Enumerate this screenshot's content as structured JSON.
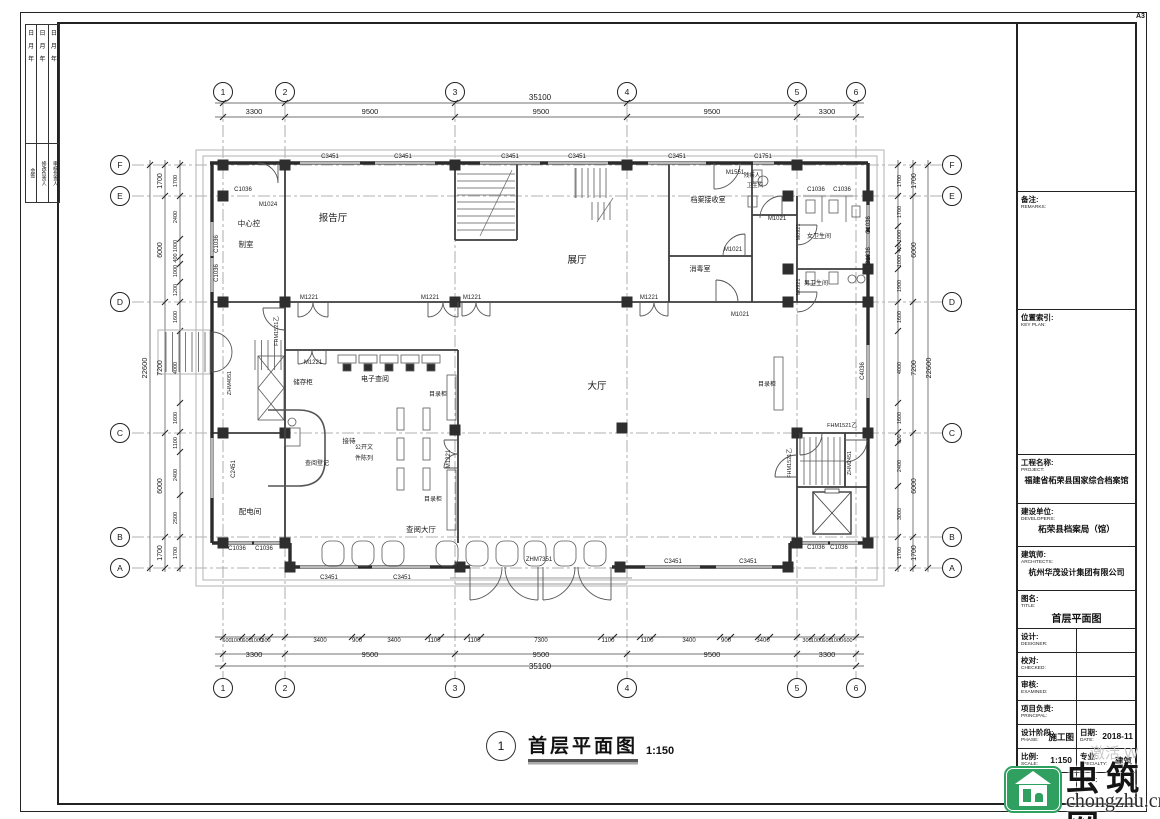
{
  "sheet": {
    "size_label": "A3"
  },
  "corner_strip": {
    "date_chars": [
      "日",
      "月",
      "年"
    ],
    "column_labels": [
      "会签",
      "修改负责人",
      "审核负责人"
    ]
  },
  "title_block": {
    "remarks": {
      "zh": "备注:",
      "en": "REMARKS:"
    },
    "key_plan": {
      "zh": "位置索引:",
      "en": "KEY PLAN:"
    },
    "project": {
      "zh": "工程名称:",
      "en": "PROJECT:",
      "value": "福建省柘荣县国家综合档案馆"
    },
    "developers": {
      "zh": "建设单位:",
      "en": "DEVELOPERS:",
      "value": "柘荣县档案局（馆）"
    },
    "architects": {
      "zh": "建筑师:",
      "en": "ARCHITECTS:",
      "value": "杭州华茂设计集团有限公司"
    },
    "title": {
      "zh": "图名:",
      "en": "TITLE:",
      "value": "首层平面图"
    },
    "designer": {
      "zh": "设计:",
      "en": "DESIGNER:"
    },
    "checked": {
      "zh": "校对:",
      "en": "CHECKED:"
    },
    "examined": {
      "zh": "审核:",
      "en": "EXAMINED:"
    },
    "principal": {
      "zh": "项目负责:",
      "en": "PRINCIPAL:"
    },
    "phase": {
      "zh": "设计阶段:",
      "en": "PHASE:",
      "value": "施工图"
    },
    "date": {
      "zh": "日期:",
      "en": "DATE:",
      "value": "2018-11"
    },
    "scale": {
      "zh": "比例:",
      "en": "SCALE:",
      "value": "1:150"
    },
    "specialty": {
      "zh": "专业:",
      "en": "SPECIALTY:",
      "value": "建筑"
    },
    "dwg_no": {
      "zh": "图号:",
      "en": "DWG. NO:"
    },
    "rev": "REV:"
  },
  "drawing_title": {
    "number": "1",
    "name": "首层平面图",
    "scale": "1:150"
  },
  "watermark": {
    "site_name": "虫筑网",
    "domain": "chongzhu.cn",
    "brand_color": "#2fa05f",
    "activation_text": "激活 W"
  },
  "dimensions": {
    "top": {
      "total": "35100",
      "segments": [
        "3300",
        "9500",
        "9500",
        "9500",
        "3300"
      ]
    },
    "bottom": {
      "total": "35100",
      "segments": [
        "3300",
        "9500",
        "9500",
        "9500",
        "3300"
      ],
      "detail": [
        "600",
        "1000",
        "600",
        "1000",
        "300",
        "3400",
        "900",
        "3400",
        "1100",
        "1100",
        "7300",
        "1100",
        "1100",
        "3400",
        "900",
        "3400",
        "300",
        "1000",
        "600",
        "1000",
        "600"
      ]
    },
    "left": {
      "total": "22600",
      "segments": [
        "1700",
        "6000",
        "7200",
        "6000",
        "1700"
      ],
      "detail": [
        "1700",
        "2400",
        "1000",
        "400",
        "1000",
        "1200",
        "1600",
        "4000",
        "1600",
        "1100",
        "2400",
        "2500",
        "1700"
      ]
    },
    "right": {
      "total": "22600",
      "segments": [
        "1700",
        "6000",
        "7200",
        "6000",
        "1700"
      ],
      "detail": [
        "1700",
        "1700",
        "1000",
        "400",
        "1000",
        "1900",
        "1600",
        "4000",
        "1600",
        "600",
        "2400",
        "3000",
        "1700"
      ]
    }
  },
  "plan": {
    "bubbles": [
      {
        "t": "1",
        "x": 223,
        "y": 92
      },
      {
        "t": "2",
        "x": 285,
        "y": 92
      },
      {
        "t": "3",
        "x": 455,
        "y": 92
      },
      {
        "t": "4",
        "x": 627,
        "y": 92
      },
      {
        "t": "5",
        "x": 797,
        "y": 92
      },
      {
        "t": "6",
        "x": 856,
        "y": 92
      },
      {
        "t": "1",
        "x": 223,
        "y": 688
      },
      {
        "t": "2",
        "x": 285,
        "y": 688
      },
      {
        "t": "3",
        "x": 455,
        "y": 688
      },
      {
        "t": "4",
        "x": 627,
        "y": 688
      },
      {
        "t": "5",
        "x": 797,
        "y": 688
      },
      {
        "t": "6",
        "x": 856,
        "y": 688
      },
      {
        "t": "F",
        "x": 120,
        "y": 165
      },
      {
        "t": "E",
        "x": 120,
        "y": 196
      },
      {
        "t": "D",
        "x": 120,
        "y": 302
      },
      {
        "t": "C",
        "x": 120,
        "y": 433
      },
      {
        "t": "B",
        "x": 120,
        "y": 537
      },
      {
        "t": "A",
        "x": 120,
        "y": 568
      },
      {
        "t": "F",
        "x": 952,
        "y": 165
      },
      {
        "t": "E",
        "x": 952,
        "y": 196
      },
      {
        "t": "D",
        "x": 952,
        "y": 302
      },
      {
        "t": "C",
        "x": 952,
        "y": 433
      },
      {
        "t": "B",
        "x": 952,
        "y": 537
      },
      {
        "t": "A",
        "x": 952,
        "y": 568
      }
    ],
    "labels": [
      {
        "t": "35100",
        "x": 540,
        "y": 100,
        "fs": 8
      },
      {
        "t": "3300",
        "x": 254,
        "y": 114,
        "fs": 7.5
      },
      {
        "t": "9500",
        "x": 370,
        "y": 114,
        "fs": 7.5
      },
      {
        "t": "9500",
        "x": 541,
        "y": 114,
        "fs": 7.5
      },
      {
        "t": "9500",
        "x": 712,
        "y": 114,
        "fs": 7.5
      },
      {
        "t": "3300",
        "x": 827,
        "y": 114,
        "fs": 7.5
      },
      {
        "t": "600",
        "x": 227,
        "y": 642,
        "fs": 5.5
      },
      {
        "t": "1000",
        "x": 237,
        "y": 642,
        "fs": 5.5
      },
      {
        "t": "600",
        "x": 247,
        "y": 642,
        "fs": 5.5
      },
      {
        "t": "1000",
        "x": 257,
        "y": 642,
        "fs": 5.5
      },
      {
        "t": "300",
        "x": 266,
        "y": 642,
        "fs": 5.5
      },
      {
        "t": "3400",
        "x": 320,
        "y": 642,
        "fs": 6
      },
      {
        "t": "900",
        "x": 357,
        "y": 642,
        "fs": 6
      },
      {
        "t": "3400",
        "x": 394,
        "y": 642,
        "fs": 6
      },
      {
        "t": "1100",
        "x": 434,
        "y": 642,
        "fs": 6
      },
      {
        "t": "1100",
        "x": 474,
        "y": 642,
        "fs": 6
      },
      {
        "t": "7300",
        "x": 541,
        "y": 642,
        "fs": 6
      },
      {
        "t": "1100",
        "x": 608,
        "y": 642,
        "fs": 6
      },
      {
        "t": "1100",
        "x": 647,
        "y": 642,
        "fs": 6
      },
      {
        "t": "3400",
        "x": 689,
        "y": 642,
        "fs": 6
      },
      {
        "t": "900",
        "x": 726,
        "y": 642,
        "fs": 6
      },
      {
        "t": "3400",
        "x": 763,
        "y": 642,
        "fs": 6
      },
      {
        "t": "300",
        "x": 807,
        "y": 642,
        "fs": 5.5
      },
      {
        "t": "1000",
        "x": 817,
        "y": 642,
        "fs": 5.5
      },
      {
        "t": "600",
        "x": 827,
        "y": 642,
        "fs": 5.5
      },
      {
        "t": "1000",
        "x": 837,
        "y": 642,
        "fs": 5.5
      },
      {
        "t": "600",
        "x": 848,
        "y": 642,
        "fs": 5.5
      },
      {
        "t": "3300",
        "x": 254,
        "y": 657,
        "fs": 7.5
      },
      {
        "t": "9500",
        "x": 370,
        "y": 657,
        "fs": 7.5
      },
      {
        "t": "9500",
        "x": 541,
        "y": 657,
        "fs": 7.5
      },
      {
        "t": "9500",
        "x": 712,
        "y": 657,
        "fs": 7.5
      },
      {
        "t": "3300",
        "x": 827,
        "y": 657,
        "fs": 7.5
      },
      {
        "t": "35100",
        "x": 540,
        "y": 669,
        "fs": 8
      },
      {
        "t": "22600",
        "x": 147,
        "y": 368,
        "fs": 7.5,
        "r": -90
      },
      {
        "t": "1700",
        "x": 162,
        "y": 181,
        "fs": 7,
        "r": -90
      },
      {
        "t": "6000",
        "x": 162,
        "y": 250,
        "fs": 7,
        "r": -90
      },
      {
        "t": "7200",
        "x": 162,
        "y": 368,
        "fs": 7,
        "r": -90
      },
      {
        "t": "6000",
        "x": 162,
        "y": 486,
        "fs": 7,
        "r": -90
      },
      {
        "t": "1700",
        "x": 162,
        "y": 553,
        "fs": 7,
        "r": -90
      },
      {
        "t": "1700",
        "x": 177,
        "y": 181,
        "fs": 5.5,
        "r": -90
      },
      {
        "t": "2400",
        "x": 177,
        "y": 217,
        "fs": 5.5,
        "r": -90
      },
      {
        "t": "1000",
        "x": 177,
        "y": 246,
        "fs": 5.5,
        "r": -90
      },
      {
        "t": "400",
        "x": 177,
        "y": 258,
        "fs": 5.5,
        "r": -90
      },
      {
        "t": "1000",
        "x": 177,
        "y": 271,
        "fs": 5.5,
        "r": -90
      },
      {
        "t": "1200",
        "x": 177,
        "y": 290,
        "fs": 5.5,
        "r": -90
      },
      {
        "t": "1600",
        "x": 177,
        "y": 317,
        "fs": 5.5,
        "r": -90
      },
      {
        "t": "4000",
        "x": 177,
        "y": 368,
        "fs": 5.5,
        "r": -90
      },
      {
        "t": "1600",
        "x": 177,
        "y": 418,
        "fs": 5.5,
        "r": -90
      },
      {
        "t": "1100",
        "x": 177,
        "y": 443,
        "fs": 5.5,
        "r": -90
      },
      {
        "t": "2400",
        "x": 177,
        "y": 475,
        "fs": 5.5,
        "r": -90
      },
      {
        "t": "2500",
        "x": 177,
        "y": 518,
        "fs": 5.5,
        "r": -90
      },
      {
        "t": "1700",
        "x": 177,
        "y": 553,
        "fs": 5.5,
        "r": -90
      },
      {
        "t": "22600",
        "x": 931,
        "y": 368,
        "fs": 7.5,
        "r": -90
      },
      {
        "t": "1700",
        "x": 916,
        "y": 181,
        "fs": 7,
        "r": -90
      },
      {
        "t": "6000",
        "x": 916,
        "y": 250,
        "fs": 7,
        "r": -90
      },
      {
        "t": "7200",
        "x": 916,
        "y": 368,
        "fs": 7,
        "r": -90
      },
      {
        "t": "6000",
        "x": 916,
        "y": 486,
        "fs": 7,
        "r": -90
      },
      {
        "t": "1700",
        "x": 916,
        "y": 553,
        "fs": 7,
        "r": -90
      },
      {
        "t": "1700",
        "x": 901,
        "y": 181,
        "fs": 5.5,
        "r": -90
      },
      {
        "t": "1700",
        "x": 901,
        "y": 212,
        "fs": 5.5,
        "r": -90
      },
      {
        "t": "1000",
        "x": 901,
        "y": 236,
        "fs": 5.5,
        "r": -90
      },
      {
        "t": "400",
        "x": 901,
        "y": 248,
        "fs": 5.5,
        "r": -90
      },
      {
        "t": "1000",
        "x": 901,
        "y": 261,
        "fs": 5.5,
        "r": -90
      },
      {
        "t": "1900",
        "x": 901,
        "y": 286,
        "fs": 5.5,
        "r": -90
      },
      {
        "t": "1600",
        "x": 901,
        "y": 317,
        "fs": 5.5,
        "r": -90
      },
      {
        "t": "4000",
        "x": 901,
        "y": 368,
        "fs": 5.5,
        "r": -90
      },
      {
        "t": "1600",
        "x": 901,
        "y": 418,
        "fs": 5.5,
        "r": -90
      },
      {
        "t": "600",
        "x": 901,
        "y": 439,
        "fs": 5.5,
        "r": -90
      },
      {
        "t": "2400",
        "x": 901,
        "y": 466,
        "fs": 5.5,
        "r": -90
      },
      {
        "t": "3000",
        "x": 901,
        "y": 514,
        "fs": 5.5,
        "r": -90
      },
      {
        "t": "1700",
        "x": 901,
        "y": 553,
        "fs": 5.5,
        "r": -90
      },
      {
        "t": "中心控",
        "x": 249,
        "y": 226,
        "fs": 7.5,
        "n": "room-label"
      },
      {
        "t": "制室",
        "x": 246,
        "y": 247,
        "fs": 7.5,
        "n": "room-label"
      },
      {
        "t": "报告厅",
        "x": 333,
        "y": 221,
        "fs": 9.5,
        "n": "room-label"
      },
      {
        "t": "展厅",
        "x": 577,
        "y": 263,
        "fs": 9.5,
        "n": "room-label"
      },
      {
        "t": "档案接收室",
        "x": 708,
        "y": 202,
        "fs": 7,
        "n": "room-label"
      },
      {
        "t": "消毒室",
        "x": 700,
        "y": 271,
        "fs": 7,
        "n": "room-label"
      },
      {
        "t": "残疾人",
        "x": 752,
        "y": 177,
        "fs": 5.5,
        "n": "room-label"
      },
      {
        "t": "卫生间",
        "x": 755,
        "y": 187,
        "fs": 5.5,
        "n": "room-label"
      },
      {
        "t": "女卫生间",
        "x": 819,
        "y": 238,
        "fs": 6,
        "n": "room-label"
      },
      {
        "t": "男卫生间",
        "x": 816,
        "y": 285,
        "fs": 6,
        "n": "room-label"
      },
      {
        "t": "大厅",
        "x": 597,
        "y": 389,
        "fs": 9.5,
        "n": "room-label"
      },
      {
        "t": "储存柜",
        "x": 303,
        "y": 384,
        "fs": 6.5,
        "n": "room-label"
      },
      {
        "t": "电子查阅",
        "x": 375,
        "y": 381,
        "fs": 7,
        "n": "room-label"
      },
      {
        "t": "目录柜",
        "x": 438,
        "y": 396,
        "fs": 6,
        "n": "room-label"
      },
      {
        "t": "目录柜",
        "x": 433,
        "y": 501,
        "fs": 6,
        "n": "room-label"
      },
      {
        "t": "目录柜",
        "x": 767,
        "y": 386,
        "fs": 6,
        "n": "room-label"
      },
      {
        "t": "接待",
        "x": 349,
        "y": 443,
        "fs": 6.5,
        "n": "room-label"
      },
      {
        "t": "查阅登记",
        "x": 317,
        "y": 465,
        "fs": 6,
        "n": "room-label"
      },
      {
        "t": "公开文",
        "x": 364,
        "y": 449,
        "fs": 6,
        "n": "room-label"
      },
      {
        "t": "件陈列",
        "x": 364,
        "y": 460,
        "fs": 6,
        "n": "room-label"
      },
      {
        "t": "配电间",
        "x": 250,
        "y": 514,
        "fs": 7.5,
        "n": "room-label"
      },
      {
        "t": "查阅大厅",
        "x": 421,
        "y": 532,
        "fs": 7.5,
        "n": "room-label"
      },
      {
        "t": "C3451",
        "x": 330,
        "y": 158,
        "fs": 6,
        "n": "tag-label"
      },
      {
        "t": "C3451",
        "x": 403,
        "y": 158,
        "fs": 6,
        "n": "tag-label"
      },
      {
        "t": "C3451",
        "x": 510,
        "y": 158,
        "fs": 6,
        "n": "tag-label"
      },
      {
        "t": "C3451",
        "x": 577,
        "y": 158,
        "fs": 6,
        "n": "tag-label"
      },
      {
        "t": "C3451",
        "x": 677,
        "y": 158,
        "fs": 6,
        "n": "tag-label"
      },
      {
        "t": "C1751",
        "x": 763,
        "y": 158,
        "fs": 6,
        "n": "tag-label"
      },
      {
        "t": "M1551",
        "x": 735,
        "y": 174,
        "fs": 6,
        "n": "tag-label"
      },
      {
        "t": "M1024",
        "x": 268,
        "y": 206,
        "fs": 6,
        "n": "tag-label"
      },
      {
        "t": "C1036",
        "x": 243,
        "y": 191,
        "fs": 6,
        "n": "tag-label"
      },
      {
        "t": "C1036",
        "x": 816,
        "y": 191,
        "fs": 6,
        "n": "tag-label"
      },
      {
        "t": "C1036",
        "x": 842,
        "y": 191,
        "fs": 6,
        "n": "tag-label"
      },
      {
        "t": "C1036",
        "x": 218,
        "y": 244,
        "fs": 6,
        "r": -90,
        "n": "tag-label"
      },
      {
        "t": "C1036",
        "x": 218,
        "y": 273,
        "fs": 6,
        "r": -90,
        "n": "tag-label"
      },
      {
        "t": "FHM1521乙",
        "x": 278,
        "y": 331,
        "fs": 5.5,
        "r": -90,
        "n": "tag-label"
      },
      {
        "t": "ZHM4051",
        "x": 231,
        "y": 383,
        "fs": 5.5,
        "r": -90,
        "n": "tag-label"
      },
      {
        "t": "C2451",
        "x": 235,
        "y": 469,
        "fs": 6,
        "r": -90,
        "n": "tag-label"
      },
      {
        "t": "M1221",
        "x": 309,
        "y": 299,
        "fs": 6,
        "n": "tag-label"
      },
      {
        "t": "M1221",
        "x": 430,
        "y": 299,
        "fs": 6,
        "n": "tag-label"
      },
      {
        "t": "M1221",
        "x": 472,
        "y": 299,
        "fs": 6,
        "n": "tag-label"
      },
      {
        "t": "M1221",
        "x": 649,
        "y": 299,
        "fs": 6,
        "n": "tag-label"
      },
      {
        "t": "M1221",
        "x": 313,
        "y": 364,
        "fs": 6,
        "n": "tag-label"
      },
      {
        "t": "M1221",
        "x": 450,
        "y": 459,
        "fs": 6,
        "r": -90,
        "n": "tag-label"
      },
      {
        "t": "M1021",
        "x": 777,
        "y": 220,
        "fs": 6,
        "n": "tag-label"
      },
      {
        "t": "M1021",
        "x": 733,
        "y": 251,
        "fs": 6,
        "n": "tag-label"
      },
      {
        "t": "M1021",
        "x": 740,
        "y": 316,
        "fs": 6,
        "n": "tag-label"
      },
      {
        "t": "M0921",
        "x": 800,
        "y": 232,
        "fs": 5.5,
        "r": -90,
        "n": "tag-label"
      },
      {
        "t": "M0921",
        "x": 800,
        "y": 287,
        "fs": 5.5,
        "r": -90,
        "n": "tag-label"
      },
      {
        "t": "FHM1521乙",
        "x": 842,
        "y": 427,
        "fs": 5.5,
        "n": "tag-label"
      },
      {
        "t": "FHM1521乙",
        "x": 791,
        "y": 463,
        "fs": 5.5,
        "r": -90,
        "n": "tag-label"
      },
      {
        "t": "ZHM2451",
        "x": 851,
        "y": 463,
        "fs": 5.5,
        "r": -90,
        "n": "tag-label"
      },
      {
        "t": "C4036",
        "x": 864,
        "y": 371,
        "fs": 6,
        "r": -90,
        "n": "tag-label"
      },
      {
        "t": "C1036",
        "x": 870,
        "y": 225,
        "fs": 6,
        "r": -90,
        "n": "tag-label"
      },
      {
        "t": "C1036",
        "x": 870,
        "y": 256,
        "fs": 6,
        "r": -90,
        "n": "tag-label"
      },
      {
        "t": "C1036",
        "x": 237,
        "y": 550,
        "fs": 6,
        "n": "tag-label"
      },
      {
        "t": "C1036",
        "x": 264,
        "y": 550,
        "fs": 6,
        "n": "tag-label"
      },
      {
        "t": "C1036",
        "x": 816,
        "y": 549,
        "fs": 6,
        "n": "tag-label"
      },
      {
        "t": "C1036",
        "x": 839,
        "y": 549,
        "fs": 6,
        "n": "tag-label"
      },
      {
        "t": "C3451",
        "x": 329,
        "y": 579,
        "fs": 6,
        "n": "tag-label"
      },
      {
        "t": "C3451",
        "x": 402,
        "y": 579,
        "fs": 6,
        "n": "tag-label"
      },
      {
        "t": "C3451",
        "x": 673,
        "y": 563,
        "fs": 6,
        "n": "tag-label"
      },
      {
        "t": "C3451",
        "x": 748,
        "y": 563,
        "fs": 6,
        "n": "tag-label"
      },
      {
        "t": "ZHM7351",
        "x": 539,
        "y": 561,
        "fs": 6,
        "n": "tag-label"
      }
    ]
  }
}
